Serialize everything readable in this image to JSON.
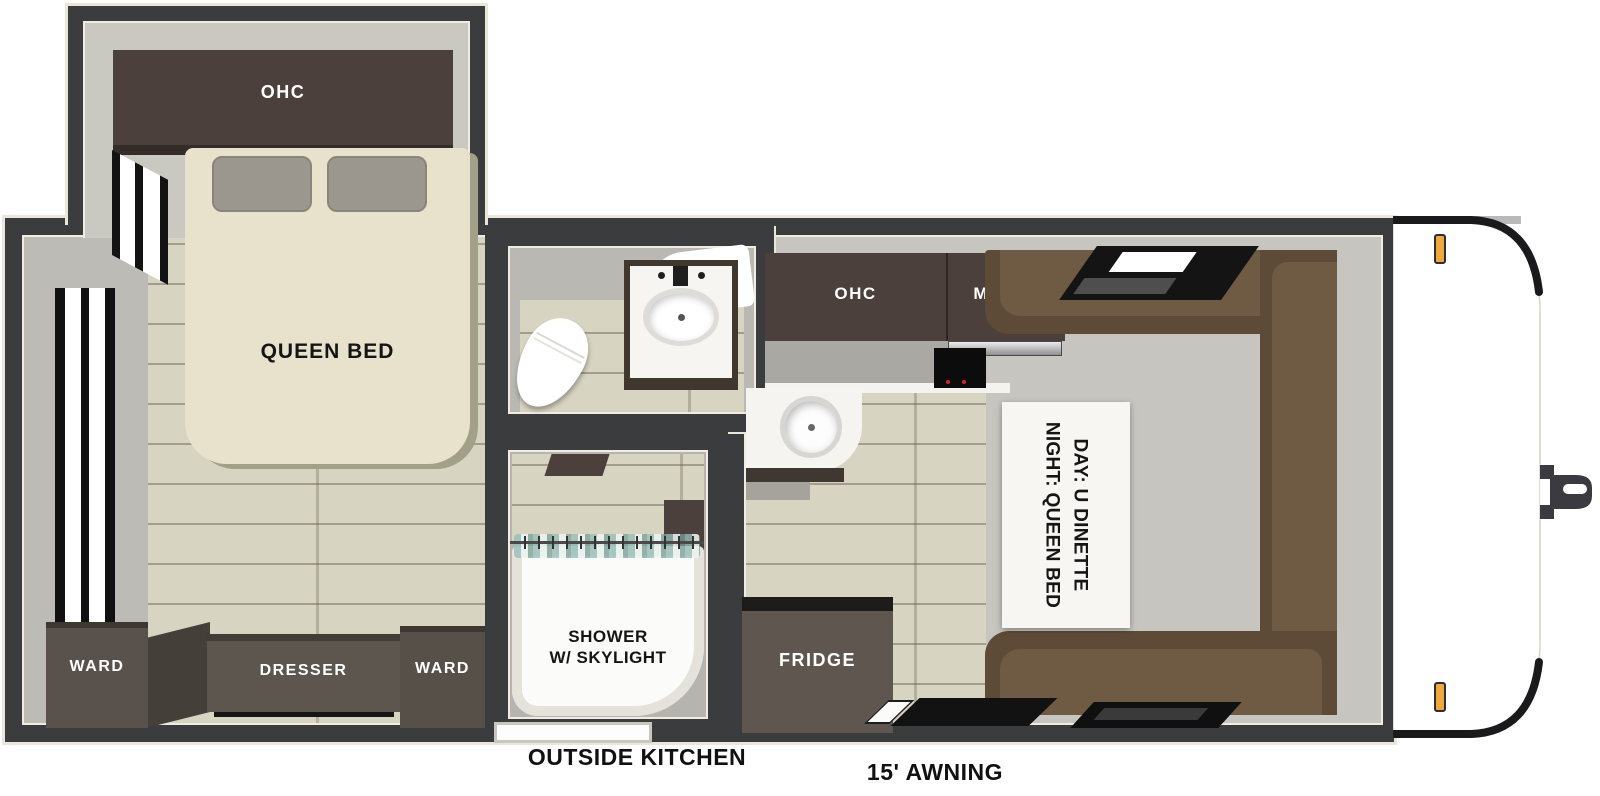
{
  "title": "Travel trailer floor plan",
  "labels": {
    "bedroom_ohc": "OHC",
    "queen_bed": "QUEEN BED",
    "ward_left": "WARD",
    "dresser": "DRESSER",
    "ward_right": "WARD",
    "shower_line1": "SHOWER",
    "shower_line2": "W/ SKYLIGHT",
    "kitchen_ohc": "OHC",
    "micro": "MICRO",
    "fridge": "FRIDGE",
    "dinette_line1": "DAY: U DINETTE",
    "dinette_line2": "NIGHT: QUEEN BED",
    "outside_kitchen": "OUTSIDE KITCHEN",
    "awning": "15' AWNING"
  },
  "colors": {
    "wall": "#3a3c3e",
    "wall_outline": "#eae6da",
    "interior_wall": "#c2c1bb",
    "floor_wood": "#d8d4c2",
    "cabinet_dark_brown": "#4b403b",
    "cabinet_gray_brown": "#5d564f",
    "dinette_brown": "#5e4b37",
    "dinette_cushion": "#6f5b44",
    "bed_cream": "#e8e2cd",
    "marker_light_amber": "#f0a73c",
    "table_white": "#f7f6f3"
  }
}
